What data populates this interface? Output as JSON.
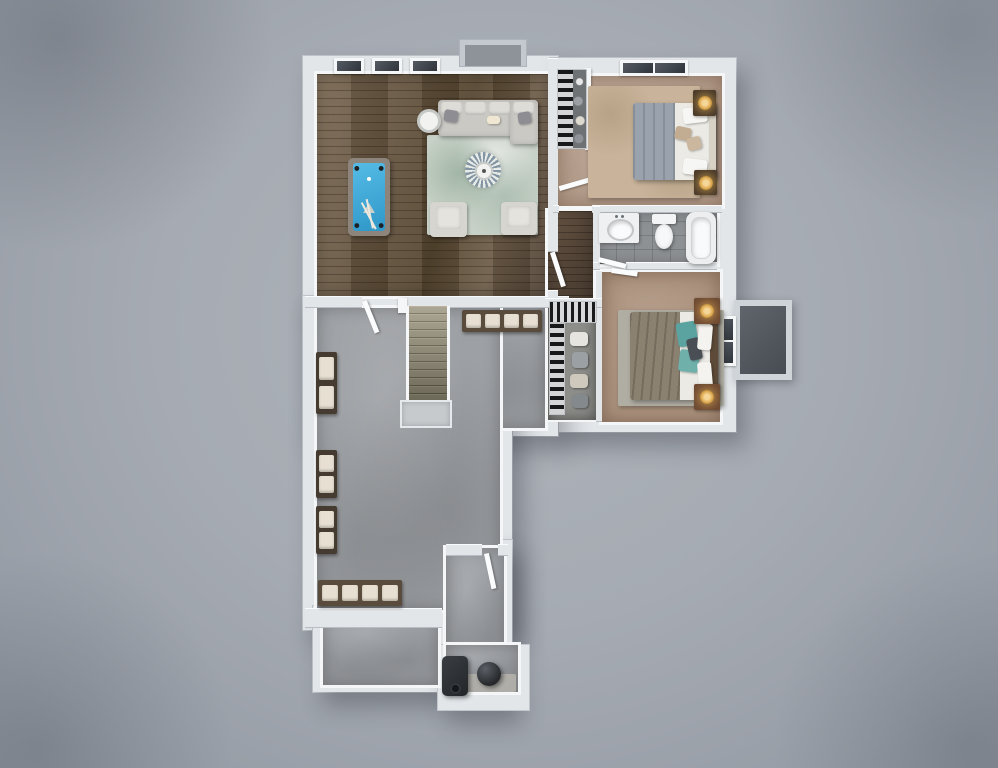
{
  "meta": {
    "image_type": "3d-rendered-floor-plan",
    "view": "top-down-dollhouse",
    "visible_text": "none",
    "plan_shape": "L-shaped footprint on gray studio background"
  },
  "palette": {
    "bg": "#a6abb3",
    "wall": "#e2e6e9",
    "wallFace": "#f4f6f7",
    "wallEdge": "#c2c7cd",
    "wood": "#6e5d49",
    "hallwood": "#5a4a3c",
    "carpet1": "#b49d8c",
    "carpet2": "#ad9480",
    "tile": "#8e9194",
    "concrete": "#9da0a4",
    "concreteLight": "#b6b4ad",
    "felt": "#3fa9dc",
    "sofa": "#cbc9c4",
    "rugSage": "#c8d1c7",
    "rugGray": "#b0aea3",
    "stairs": "#8f8a74",
    "duvet1": "#9aa3ad",
    "duvet2": "#8b8170",
    "teal": "#5ba3a0",
    "walnut": "#6e4a33",
    "lamp": "#e0ac52",
    "dark": "#2d3033",
    "benchWood": "#5a4c3d",
    "cushion": "#e7e0d2"
  },
  "rooms": [
    {
      "name": "game-room",
      "floor": "hardwood",
      "windows": 3,
      "furniture": [
        "pool-table-blue-felt",
        "sectional-sofa-with-chaise",
        "floral-area-rug",
        "armchair",
        "armchair",
        "round-side-table"
      ],
      "features": [
        "fireplace-chimney-bump"
      ]
    },
    {
      "name": "bedroom-top-right",
      "floor": "carpet",
      "furniture": [
        "bed-gray-white-bedding",
        "nightstand-with-lamp",
        "nightstand-with-lamp",
        "patterned-area-rug"
      ],
      "windows": 1,
      "features": [
        "reach-in-closet-shelving"
      ]
    },
    {
      "name": "bathroom",
      "floor": "gray-tile",
      "furniture": [
        "vanity-with-sink",
        "toilet",
        "bathtub"
      ]
    },
    {
      "name": "bedroom-middle-right",
      "floor": "carpet",
      "furniture": [
        "bed-taupe-duvet-teal-pillows",
        "walnut-nightstand-with-lamp",
        "walnut-nightstand-with-lamp",
        "gray-area-rug"
      ],
      "windows": 1,
      "features": [
        "closet-with-shelving",
        "egress-window-well"
      ]
    },
    {
      "name": "hallway",
      "floor": "dark-hardwood",
      "features": [
        "doors-to-bedrooms-and-bath"
      ]
    },
    {
      "name": "basement-rec-room",
      "floor": "concrete",
      "furniture": [
        "four-seat-bench",
        "wall-bench",
        "wall-bench",
        "wall-bench",
        "four-seat-bench"
      ],
      "features": [
        "staircase-down",
        "stair-landing",
        "open-door"
      ]
    },
    {
      "name": "utility-room",
      "floor": "concrete",
      "furniture": [
        "furnace",
        "water-heater"
      ],
      "features": [
        "door-from-rec-room"
      ]
    }
  ],
  "counts": {
    "bedrooms": 2,
    "bathrooms": 1,
    "staircases": 1,
    "windows": 5,
    "window_wells": 1
  }
}
